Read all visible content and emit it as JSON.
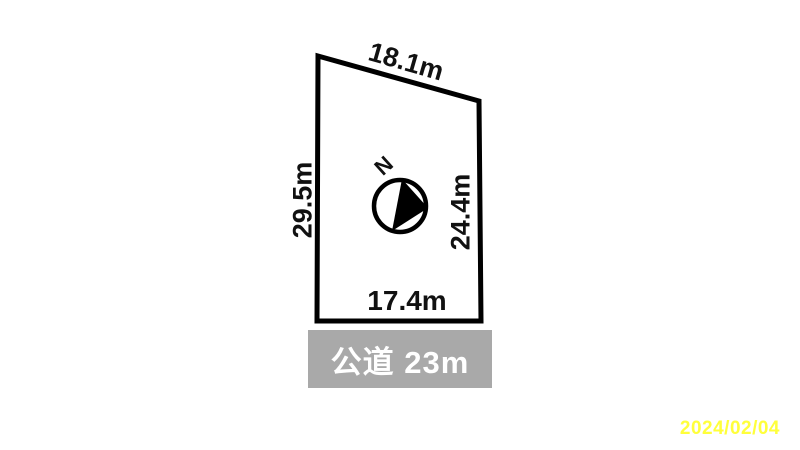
{
  "diagram": {
    "dimensions": {
      "top": "18.1m",
      "left": "29.5m",
      "right": "24.4m",
      "bottom": "17.4m"
    },
    "compass": {
      "north_label": "N"
    },
    "road": {
      "label": "公道 23m"
    },
    "date_stamp": "2024/02/04",
    "colors": {
      "plot_outline": "#000000",
      "road_bar_bg": "#a9a9a9",
      "road_bar_text": "#ffffff",
      "date_text": "#ffff3b",
      "background": "#ffffff"
    }
  }
}
